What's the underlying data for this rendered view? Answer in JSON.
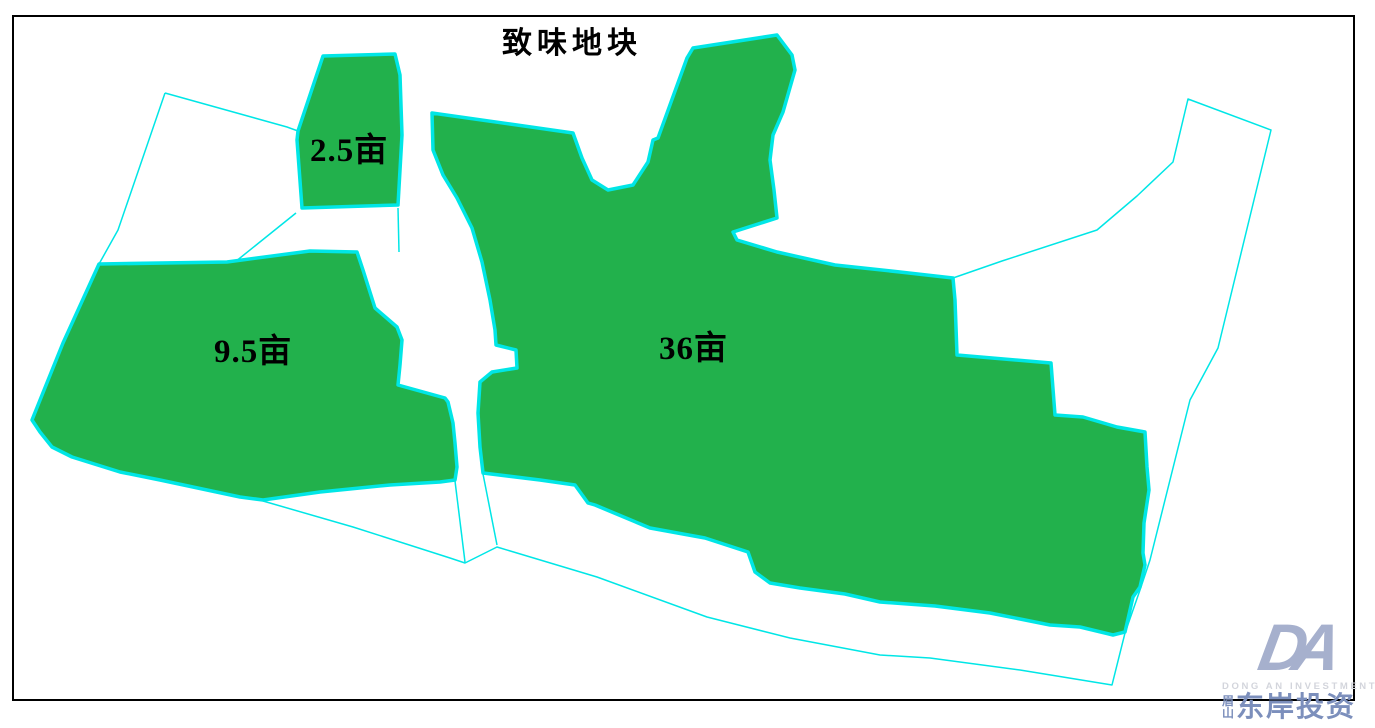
{
  "title": "致味地块",
  "map": {
    "colors": {
      "parcel_fill": "#22b14c",
      "parcel_stroke": "#00e6e6",
      "boundary_stroke": "#00e6e6",
      "frame": "#000000"
    },
    "frame": {
      "x": 13,
      "y": 16,
      "width": 1341,
      "height": 684
    },
    "parcels": [
      {
        "id": "parcel-2-5",
        "label": "2.5亩",
        "points": "323,56 395,54 400,75 402,135 398,205 302,208 297,140 298,131"
      },
      {
        "id": "parcel-9-5",
        "label": "9.5亩",
        "points": "99,264 227,262 310,251 357,252 363,270 375,308 397,327 402,340 400,365 398,385 445,398 448,402 453,423 455,443 457,467 455,480 440,482 390,485 320,492 263,500 240,497 160,480 120,472 72,457 52,447 40,432 32,420 63,343"
      },
      {
        "id": "parcel-36",
        "label": "36亩",
        "points": "432,113 510,124 573,133 582,158 592,180 608,190 633,185 648,162 653,140 658,138 687,58 693,48 777,35 792,55 795,70 783,112 773,135 770,160 774,190 777,218 733,232 737,240 777,252 835,265 900,272 953,278 955,300 957,355 1051,363 1055,415 1083,417 1117,427 1145,432 1147,467 1149,490 1144,523 1143,553 1145,565 1140,587 1133,597 1125,632 1113,635 1080,627 1050,625 990,613 935,606 880,602 845,594 800,588 770,583 755,572 748,552 705,538 650,528 595,505 588,503 575,485 540,480 483,473 480,447 478,413 480,382 492,372 517,368 516,350 496,345 495,330 490,300 482,262 472,228 457,198 443,175 433,150"
      }
    ],
    "boundary_lines": [
      "165,93 287,127 298,131",
      "165,93 118,230 99,264",
      "263,501 353,527 450,558 465,563 497,547 597,577 707,617 790,638 880,655 930,658 1020,670 1112,685 1125,633 1140,590 1150,560 1190,400 1218,348 1271,130 1188,99 1173,162 1137,196 1097,230 1002,261 953,278",
      "296,213 235,262",
      "398,208 399,252",
      "455,481 465,562",
      "483,474 497,545"
    ]
  },
  "logo": {
    "monogram": "DA",
    "subtitle": "DONG AN INVESTMENT",
    "seal_top": "眉",
    "seal_bottom": "山",
    "name": "东岸投资"
  }
}
